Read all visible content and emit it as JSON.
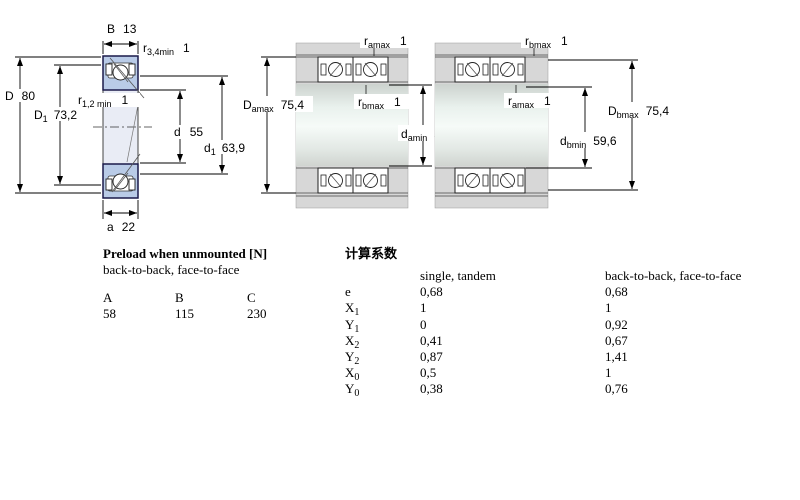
{
  "diagram_left": {
    "b": {
      "main": "B",
      "val": "13"
    },
    "r34": {
      "main": "r",
      "sub": "3,4min",
      "val": "1"
    },
    "D": {
      "main": "D",
      "val": "80"
    },
    "D1": {
      "main": "D",
      "sub": "1",
      "val": "73,2"
    },
    "r12": {
      "main": "r",
      "sub": "1,2 min",
      "val": "1"
    },
    "d": {
      "main": "d",
      "val": "55"
    },
    "d1": {
      "main": "d",
      "sub": "1",
      "val": "63,9"
    },
    "a": {
      "main": "a",
      "val": "22"
    }
  },
  "diagram_back_to_back": {
    "r_top": {
      "main": "r",
      "sub": "amax",
      "val": "1"
    },
    "r_mid": {
      "main": "r",
      "sub": "bmax",
      "val": "1"
    },
    "D_dim": {
      "main": "D",
      "sub": "amax",
      "val": "75,4"
    },
    "d_dim": {
      "main": "d",
      "sub": "amin",
      "val": "59,6"
    }
  },
  "diagram_face_to_face": {
    "r_top": {
      "main": "r",
      "sub": "bmax",
      "val": "1"
    },
    "r_mid": {
      "main": "r",
      "sub": "amax",
      "val": "1"
    },
    "D_dim": {
      "main": "D",
      "sub": "bmax",
      "val": "75,4"
    },
    "d_dim": {
      "main": "d",
      "sub": "bmin",
      "val": "59,6"
    }
  },
  "preload": {
    "title": "Preload when unmounted [N]",
    "subtitle": "back-to-back, face-to-face",
    "columns": [
      "A",
      "B",
      "C"
    ],
    "values": [
      "58",
      "115",
      "230"
    ]
  },
  "factors": {
    "title": "计算系数",
    "col1_header": "single, tandem",
    "col2_header": "back-to-back, face-to-face",
    "rows": [
      {
        "label": "e",
        "sub": "",
        "v1": "0,68",
        "v2": "0,68"
      },
      {
        "label": "X",
        "sub": "1",
        "v1": "1",
        "v2": "1"
      },
      {
        "label": "Y",
        "sub": "1",
        "v1": "0",
        "v2": "0,92"
      },
      {
        "label": "X",
        "sub": "2",
        "v1": "0,41",
        "v2": "0,67"
      },
      {
        "label": "Y",
        "sub": "2",
        "v1": "0,87",
        "v2": "1,41"
      },
      {
        "label": "X",
        "sub": "0",
        "v1": "0,5",
        "v2": "1"
      },
      {
        "label": "Y",
        "sub": "0",
        "v1": "0,38",
        "v2": "0,76"
      }
    ]
  },
  "colors": {
    "ring_blue": "#b9cbe7",
    "body_pale": "#e9ecf5",
    "housing_gray": "#d7d7d7",
    "line": "#1a1a1a"
  }
}
